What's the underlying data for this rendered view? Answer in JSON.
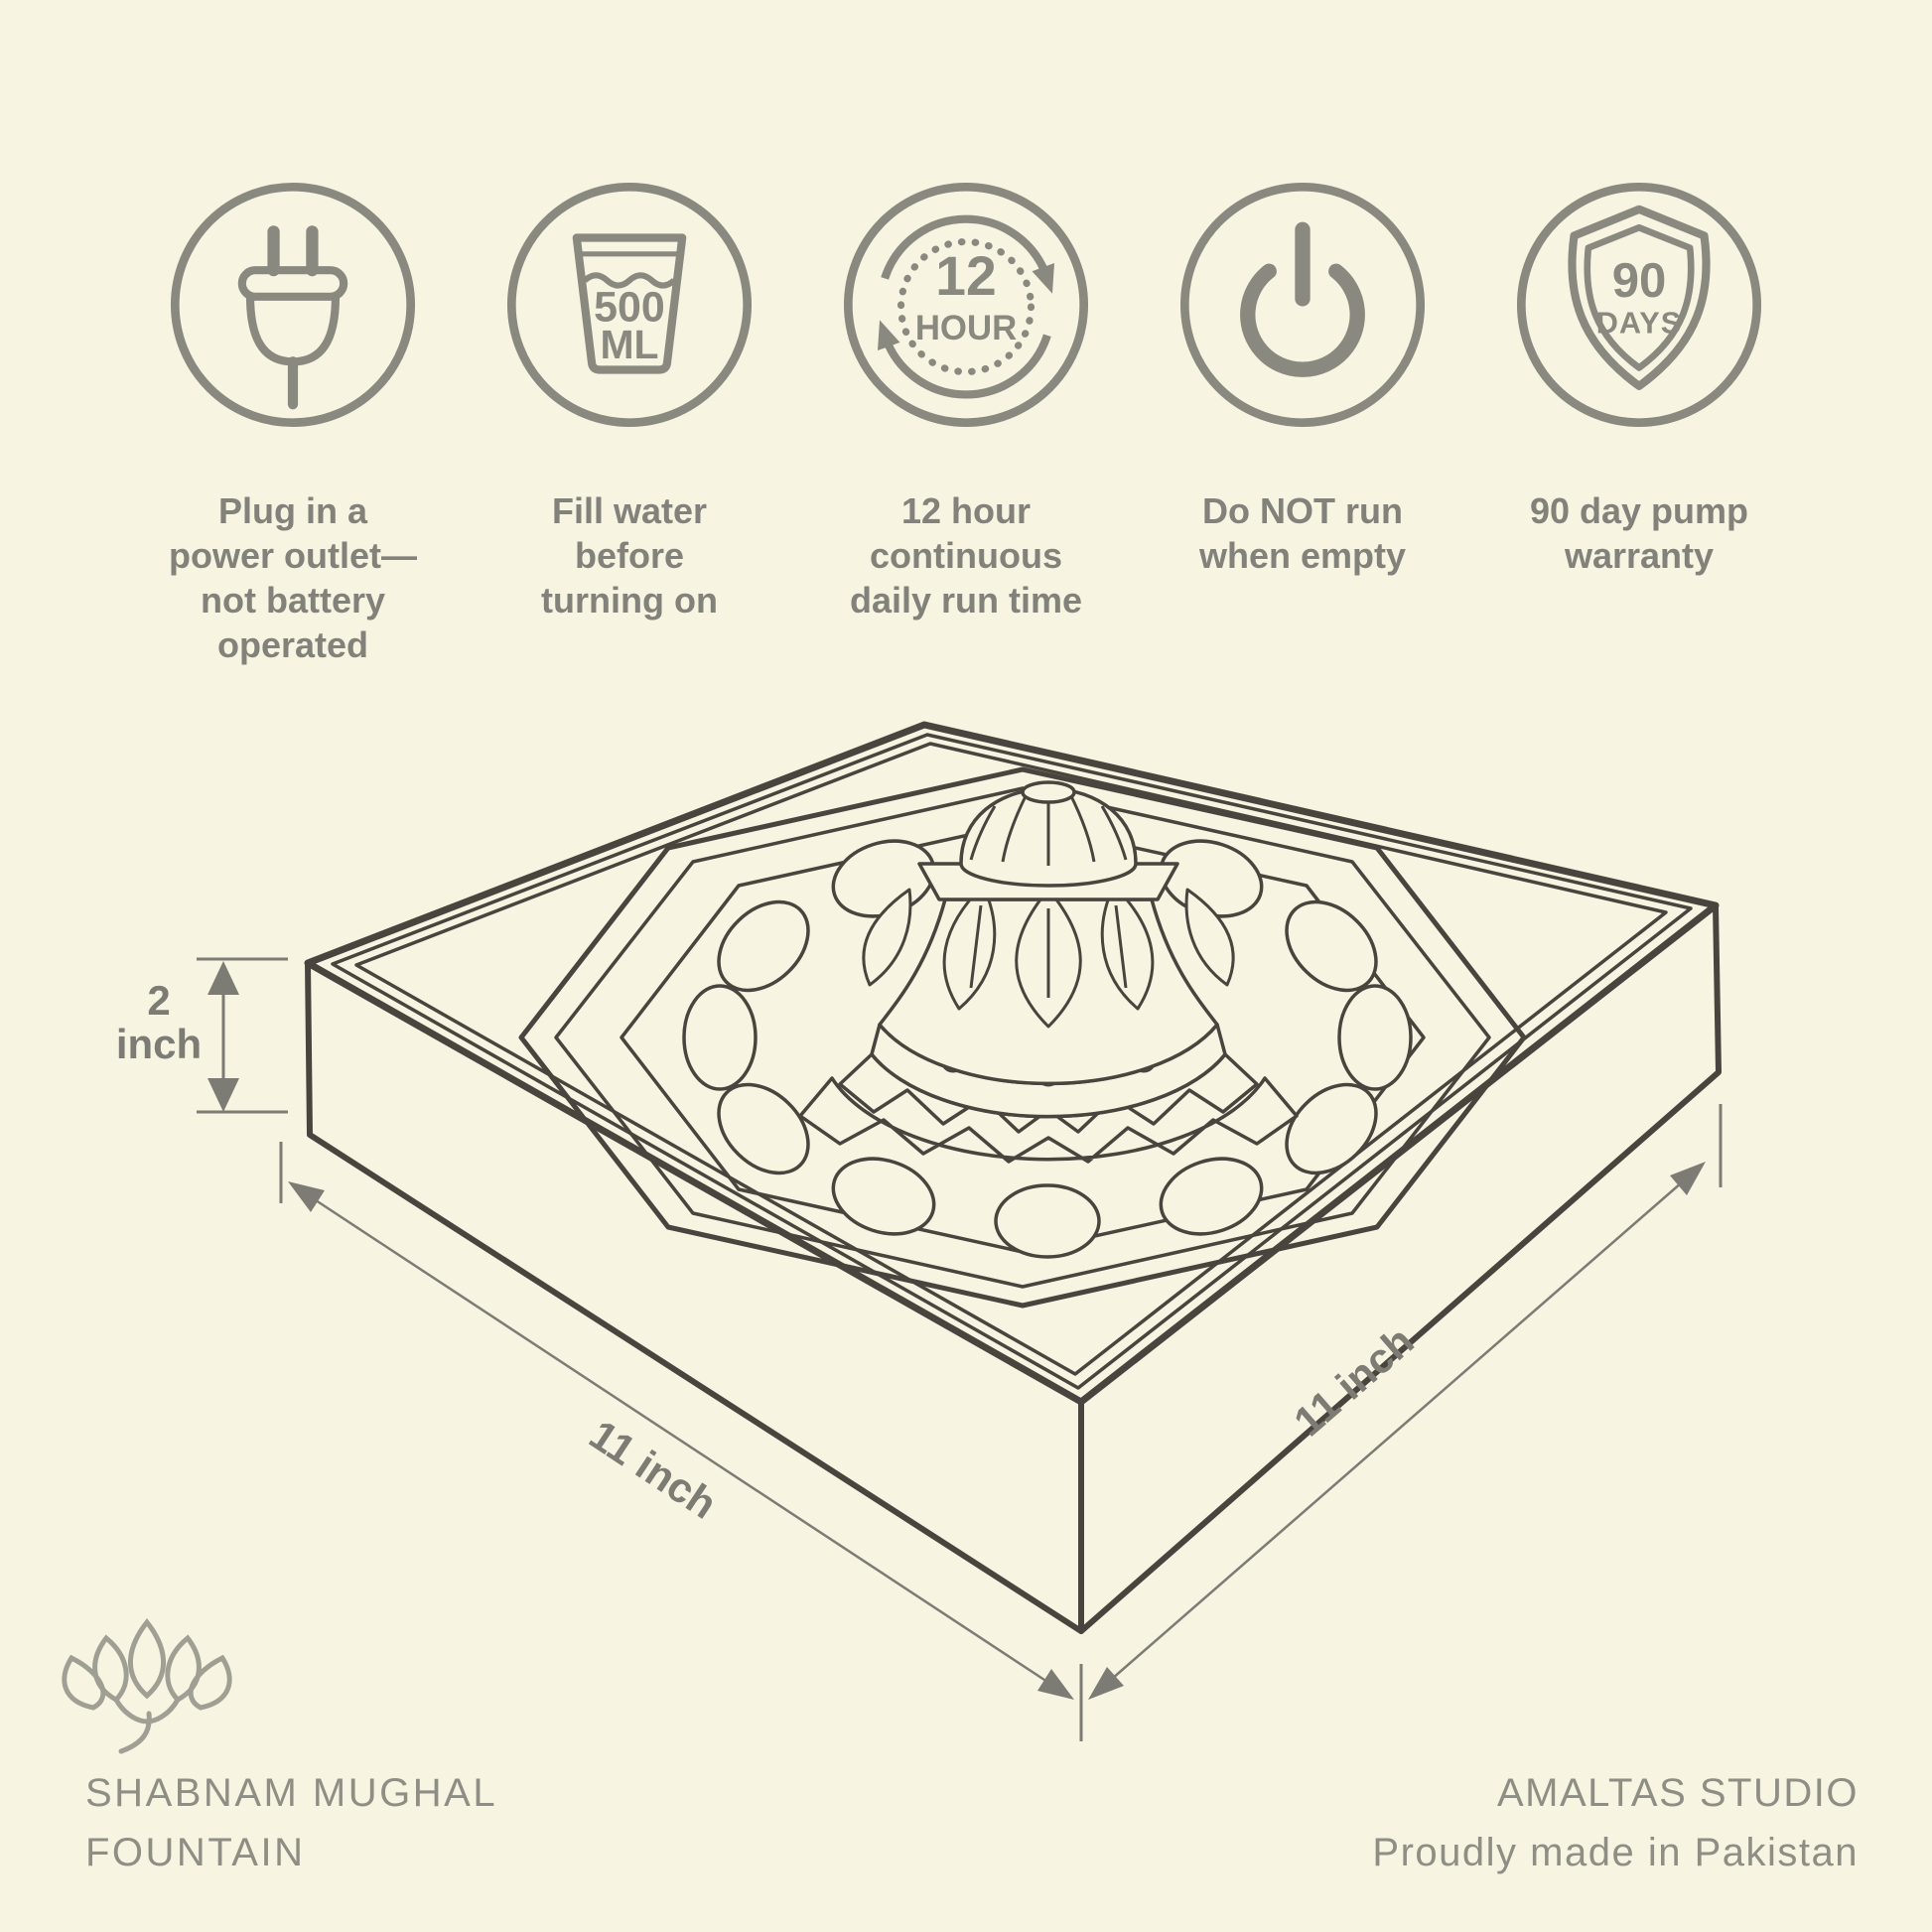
{
  "colors": {
    "background": "#f7f4e2",
    "line_art": "#49453e",
    "icon_gray": "#8a897f",
    "caption_gray": "#82817a",
    "dimension_gray": "#7d7c74",
    "brand_gray": "#8f8e84"
  },
  "features": [
    {
      "icon": "plug-icon",
      "label": "Plug in a\npower outlet—\nnot battery\noperated"
    },
    {
      "icon": "water-glass-icon",
      "badge_line1": "500",
      "badge_line2": "ML",
      "label": "Fill water\nbefore\nturning on"
    },
    {
      "icon": "12-hour-cycle-icon",
      "badge_line1": "12",
      "badge_line2": "HOUR",
      "label": "12 hour\ncontinuous\ndaily run time"
    },
    {
      "icon": "power-icon",
      "label": "Do NOT run\nwhen empty"
    },
    {
      "icon": "warranty-shield-icon",
      "badge_line1": "90",
      "badge_line2": "DAYS",
      "label": "90 day pump\nwarranty"
    }
  ],
  "diagram": {
    "height_value": "2",
    "height_unit": "inch",
    "width_label": "11 inch",
    "depth_label": "11 inch"
  },
  "footer": {
    "left_line1": "SHABNAM MUGHAL",
    "left_line2": "FOUNTAIN",
    "right_line1": "AMALTAS STUDIO",
    "right_line2": "Proudly made in Pakistan"
  }
}
